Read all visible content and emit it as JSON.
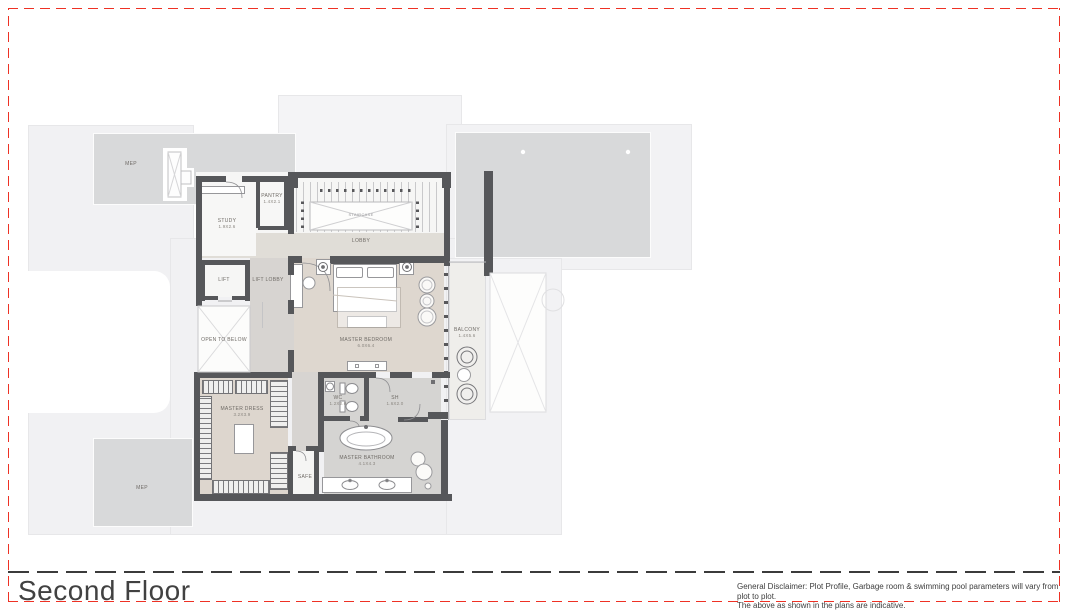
{
  "page": {
    "footer": {
      "title": "Second Floor",
      "disclaimer_line1": "General Disclaimer: Plot Profile, Garbage room & swimming pool parameters will vary from plot to plot.",
      "disclaimer_line2": "The above as shown in the plans are indicative."
    },
    "frame_color": "#ee3124"
  },
  "plan": {
    "labels": {
      "mep_top": {
        "name": "MEP"
      },
      "mep_bottom": {
        "name": "MEP"
      },
      "study": {
        "name": "STUDY",
        "dim": "1.9X2.6"
      },
      "pantry": {
        "name": "PANTRY",
        "dim": "1.4X2.1"
      },
      "staircase": {
        "name": "STAIRCASE"
      },
      "lobby": {
        "name": "LOBBY"
      },
      "lift": {
        "name": "LIFT"
      },
      "lift_lobby": {
        "name": "LIFT LOBBY"
      },
      "open_to_below": {
        "name": "OPEN TO BELOW"
      },
      "master_bedroom": {
        "name": "MASTER BEDROOM",
        "dim": "6.0X6.4"
      },
      "balcony": {
        "name": "BALCONY",
        "dim": "1.4X5.6"
      },
      "master_dress": {
        "name": "MASTER DRESS",
        "dim": "3.2X3.9"
      },
      "safe": {
        "name": "SAFE"
      },
      "wc": {
        "name": "WC",
        "dim": "1.2X2.0"
      },
      "sh": {
        "name": "SH",
        "dim": "1.6X2.0"
      },
      "master_bathroom": {
        "name": "MASTER BATHROOM",
        "dim": "4.1X4.3"
      }
    }
  }
}
